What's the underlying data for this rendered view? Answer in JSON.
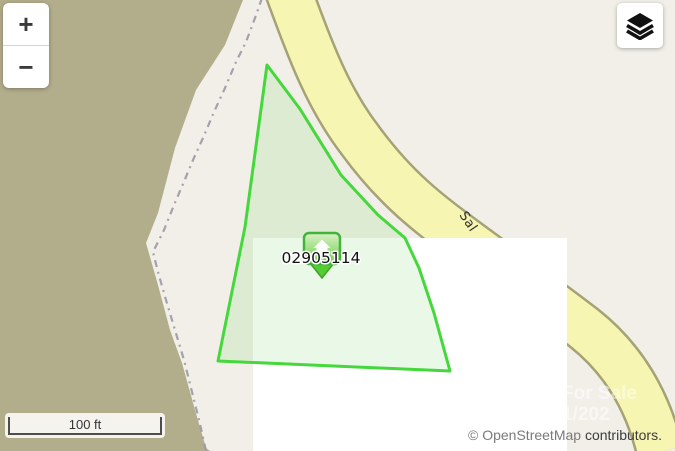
{
  "map": {
    "parcel_id_label": "02905114",
    "street_name": "Sal",
    "watermark": {
      "line1": "For Sale",
      "line2": "1/202"
    },
    "attribution": {
      "link_text": "© OpenStreetMap",
      "suffix_text": "contributors."
    },
    "colors": {
      "landuse_khaki": "#b2ad8b",
      "land_base": "#f2efe9",
      "blank_tile": "#ffffff",
      "road_fill": "#f6f5b2",
      "road_casing": "#a5a276",
      "admin_boundary_dash": "#9b98a8",
      "parcel_outline": "#45d83c",
      "parcel_fill": "rgba(90,210,70,0.13)",
      "marker_border": "#44b33c",
      "marker_fill": "#8cda6d",
      "marker_tail": "#53cd31",
      "street_text": "#2e2e2e",
      "parcel_text": "#111111"
    }
  },
  "controls": {
    "zoom_in_label": "+",
    "zoom_out_label": "−",
    "scale_label": "100 ft"
  }
}
